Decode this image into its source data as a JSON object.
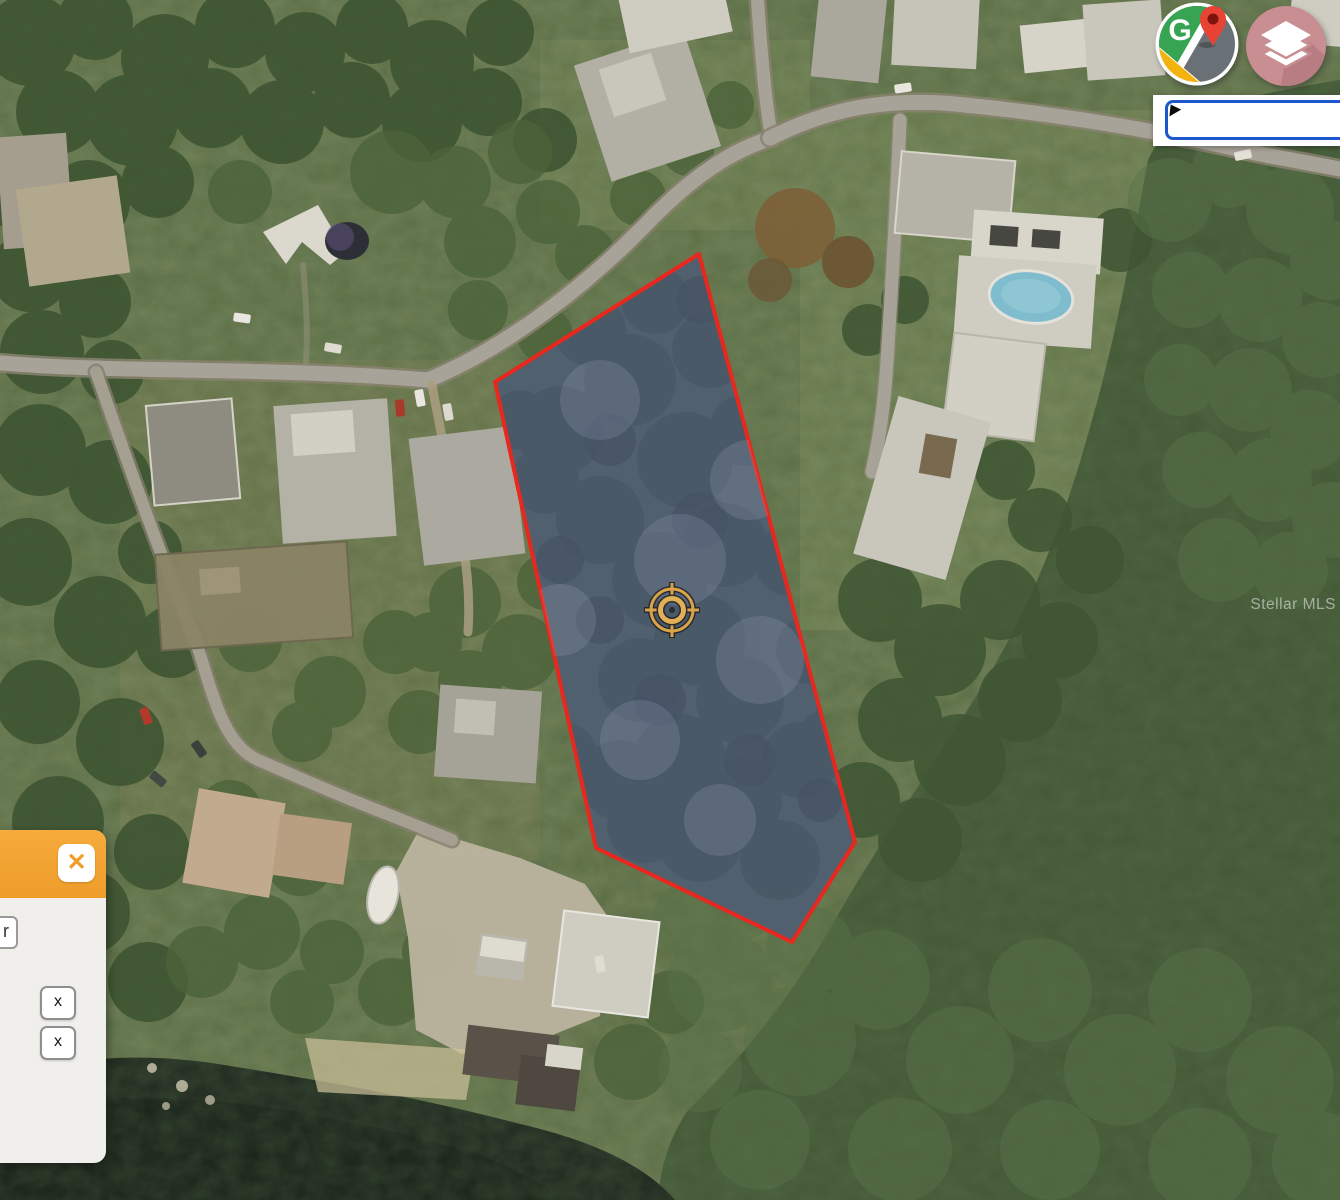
{
  "map": {
    "watermark": "Stellar MLS",
    "parcel": {
      "outline_color": "#e8281e",
      "fill_color": "#5b6b96",
      "marker": "crosshair-target"
    },
    "search": {
      "value": "",
      "placeholder": ""
    }
  },
  "controls": {
    "google_maps_label": "G",
    "layers_icon": "layers",
    "accent_blue": "#1e56cb"
  },
  "panel": {
    "header_color": "#f2a234",
    "close_glyph": "✕",
    "partial_button_label": "r",
    "row_buttons": [
      {
        "label": "x"
      },
      {
        "label": "x"
      }
    ]
  }
}
